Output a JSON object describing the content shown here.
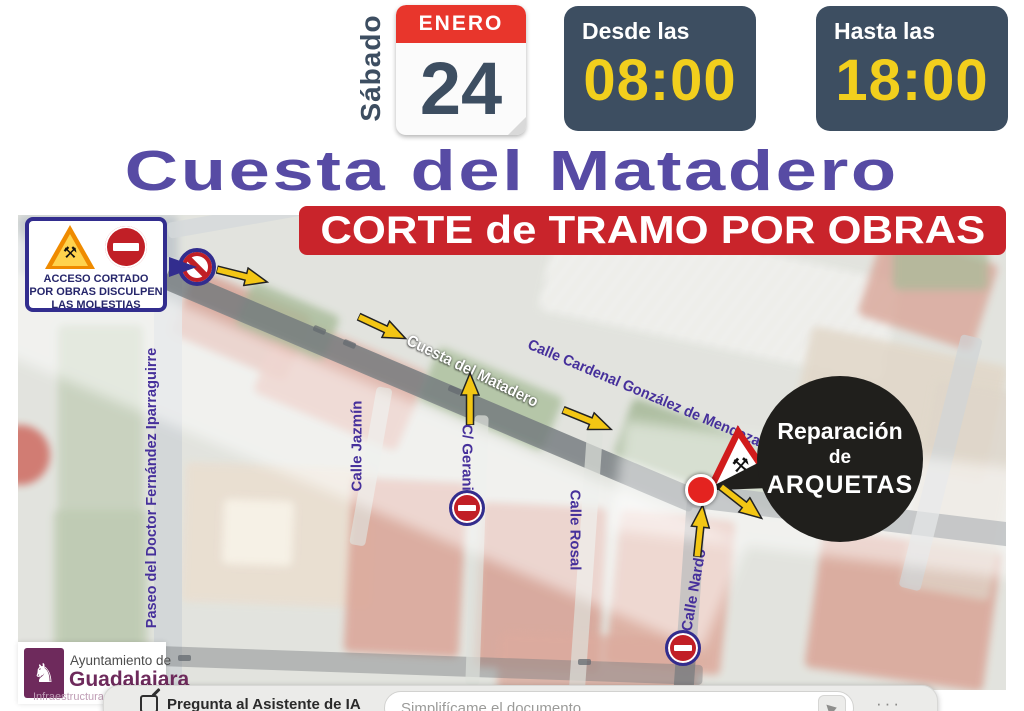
{
  "header": {
    "weekday": "Sábado",
    "calendar": {
      "month": "ENERO",
      "day": "24"
    },
    "from": {
      "label": "Desde las",
      "time": "08:00"
    },
    "until": {
      "label": "Hasta las",
      "time": "18:00"
    }
  },
  "title": "Cuesta del Matadero",
  "banner": "CORTE de TRAMO POR OBRAS",
  "map": {
    "callout": {
      "line1": "ACCESO CORTADO",
      "line2": "POR OBRAS DISCULPEN",
      "line3": "LAS MOLESTIAS"
    },
    "balloon": {
      "line1": "Reparación",
      "line2": "de",
      "line3": "ARQUETAS"
    },
    "streets": {
      "matadero": "Cuesta del Matadero",
      "mendoza": "Calle Cardenal González de Mendoza",
      "paseo": "Paseo del Doctor Fernández Iparraguirre",
      "jazmin": "Calle Jazmín",
      "geranio": "C/ Geranio",
      "rosal": "Calle Rosal",
      "nardo": "Calle Nardo"
    },
    "icons": {
      "roadworks": "roadworks-warning-triangle-icon",
      "no_entry": "no-entry-sign-icon",
      "prohibition": "prohibition-slash-sign-icon",
      "arrow": "direction-arrow-icon",
      "work_point": "work-location-dot"
    }
  },
  "footer": {
    "logo": {
      "line1": "Ayuntamiento de",
      "line2": "Guadalajara",
      "line3": "Infraestructuras"
    },
    "ai_bar": {
      "prompt_label": "Pregunta al Asistente de IA",
      "input_placeholder": "Simplifícame el documento"
    }
  },
  "colors": {
    "navy": "#3d4e61",
    "time_yellow": "#f2cf1d",
    "calendar_red": "#e8362c",
    "banner_red": "#c9242b",
    "title_purple": "#574ba4",
    "street_purple": "#46309b",
    "sign_border_purple": "#322d8e",
    "sign_red": "#c11f26",
    "arrow_yellow": "#f3c614",
    "logo_purple": "#6e2a5c"
  }
}
